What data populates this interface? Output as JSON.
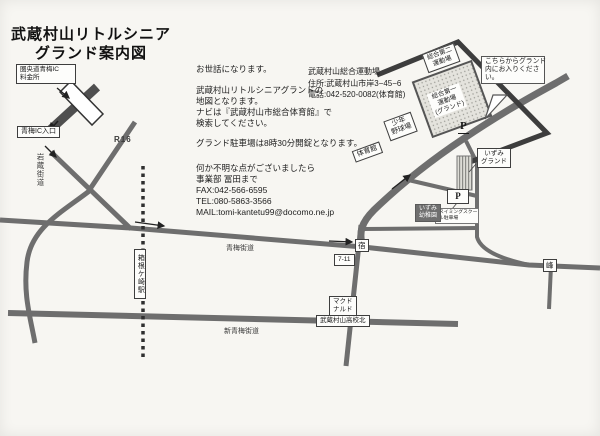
{
  "title": {
    "line1": "武蔵村山リトルシニア",
    "line2": "グランド案内図"
  },
  "intro": {
    "greeting": "お世話になります。",
    "desc1": "武蔵村山リトルシニアグランドの",
    "desc2": "地図となります。",
    "desc3": "ナビは『武蔵村山市総合体育館』で",
    "desc4": "検索してください。",
    "parking_note": "グランド駐車場は8時30分開錠となります。",
    "contact1": "何か不明な点がございましたら",
    "contact2": "事業部 冨田まで",
    "fax": "FAX:042-566-6595",
    "tel": "TEL:080-5863-3566",
    "mail": "MAIL:tomi-kantetu99@docomo.ne.jp"
  },
  "venue": {
    "name": "武蔵村山総合運動場",
    "address": "住所:武蔵村山市岸3−45−6",
    "phone": "電話:042-520-0082(体育館)"
  },
  "map": {
    "tollgate_line1": "圏央道青梅IC",
    "tollgate_line2": "料金所",
    "ic_entrance": "青梅IC入口",
    "route16": "R16",
    "iwakura_kaido": "岩蔵街道",
    "oume_kaido": "青梅街道",
    "shin_oume_kaido": "新青梅街道",
    "station": "箱根ケ崎駅",
    "shuku_crossing": "宿",
    "seven_eleven": "7-11",
    "mcdonalds_line1": "マクド",
    "mcdonalds_line2": "ナルド",
    "highschool_crossing": "武蔵村山高校北",
    "mine_crossing": "峰",
    "gym": "体育館",
    "youth_field_line1": "少年",
    "youth_field_line2": "野球場",
    "field2_line1": "総合第二",
    "field2_line2": "運動場",
    "field1_line1": "総合第一",
    "field1_line2": "運動場",
    "field1_line3": "(グランド)",
    "bubble_line1": "こちらからグランド",
    "bubble_line2": "内にお入りくださ",
    "bubble_line3": "い。",
    "izumi_ground_line1": "いずみ",
    "izumi_ground_line2": "グランド",
    "izumi_kindergarten_line1": "いずみ",
    "izumi_kindergarten_line2": "幼稚園",
    "swim_parking_line1": "スイミングスクー",
    "swim_parking_line2": "ル駐車場",
    "parking_p": "P"
  },
  "colors": {
    "road": "#6e6e6e",
    "highway": "#4f4f4f",
    "boundary": "#3d3d3d",
    "paper": "#f7f6f2"
  }
}
